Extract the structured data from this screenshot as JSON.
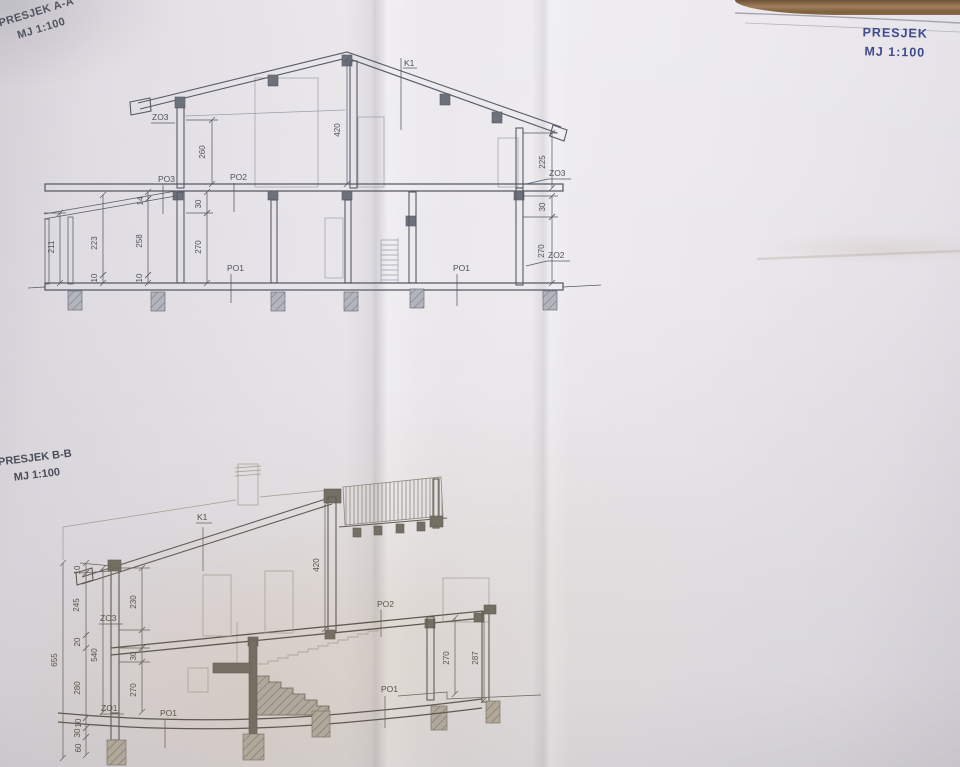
{
  "headers": {
    "section_aa": {
      "title": "PRESJEK A-A",
      "scale": "MJ 1:100"
    },
    "section_bb": {
      "title": "PRESJEK B-B",
      "scale": "MJ 1:100"
    },
    "sheet_right": {
      "title": "PRESJEK",
      "scale": "MJ 1:100"
    }
  },
  "colors": {
    "ink": "#565a66",
    "ink_warm": "#615c53",
    "light_line": "#9aa0ac",
    "blue_title": "#3f4a8e",
    "paper": "#e9e7ec",
    "wood_edge": "#8d6c49"
  },
  "section_aa": {
    "roof_mark": "K1",
    "dims": {
      "upper_left_height": "260",
      "ridge_height": "420",
      "upper_right_height": "225",
      "slab_left": "14",
      "beam_left": "30",
      "floor_left": "270",
      "wall_inner": "258",
      "porch_mid": "223",
      "porch_outer": "211",
      "plinth_a": "10",
      "plinth_b": "10",
      "beam_right": "30",
      "floor_right": "270"
    },
    "marks": {
      "z_left": "ZO3",
      "z_right_top": "ZO3",
      "z_right_bottom": "ZO2",
      "p3": "PO3",
      "p2": "PO2",
      "p1_left": "PO1",
      "p1_right": "PO1"
    }
  },
  "section_bb": {
    "roof_mark": "K1",
    "dims": {
      "wall_height": "420",
      "chain_top": "10",
      "chain_parapet": "245",
      "chain_mid": "20",
      "chain_floor": "280",
      "chain_b1": "10",
      "chain_b2": "30",
      "chain_b3": "60",
      "total": "655",
      "opening": "230",
      "storey": "540",
      "slab": "30",
      "clear_height": "270",
      "terrace_inner": "270",
      "terrace_outer": "287"
    },
    "marks": {
      "z3": "ZO3",
      "z1": "ZO1",
      "p2": "PO2",
      "p1_left": "PO1",
      "p1_right": "PO1"
    }
  }
}
